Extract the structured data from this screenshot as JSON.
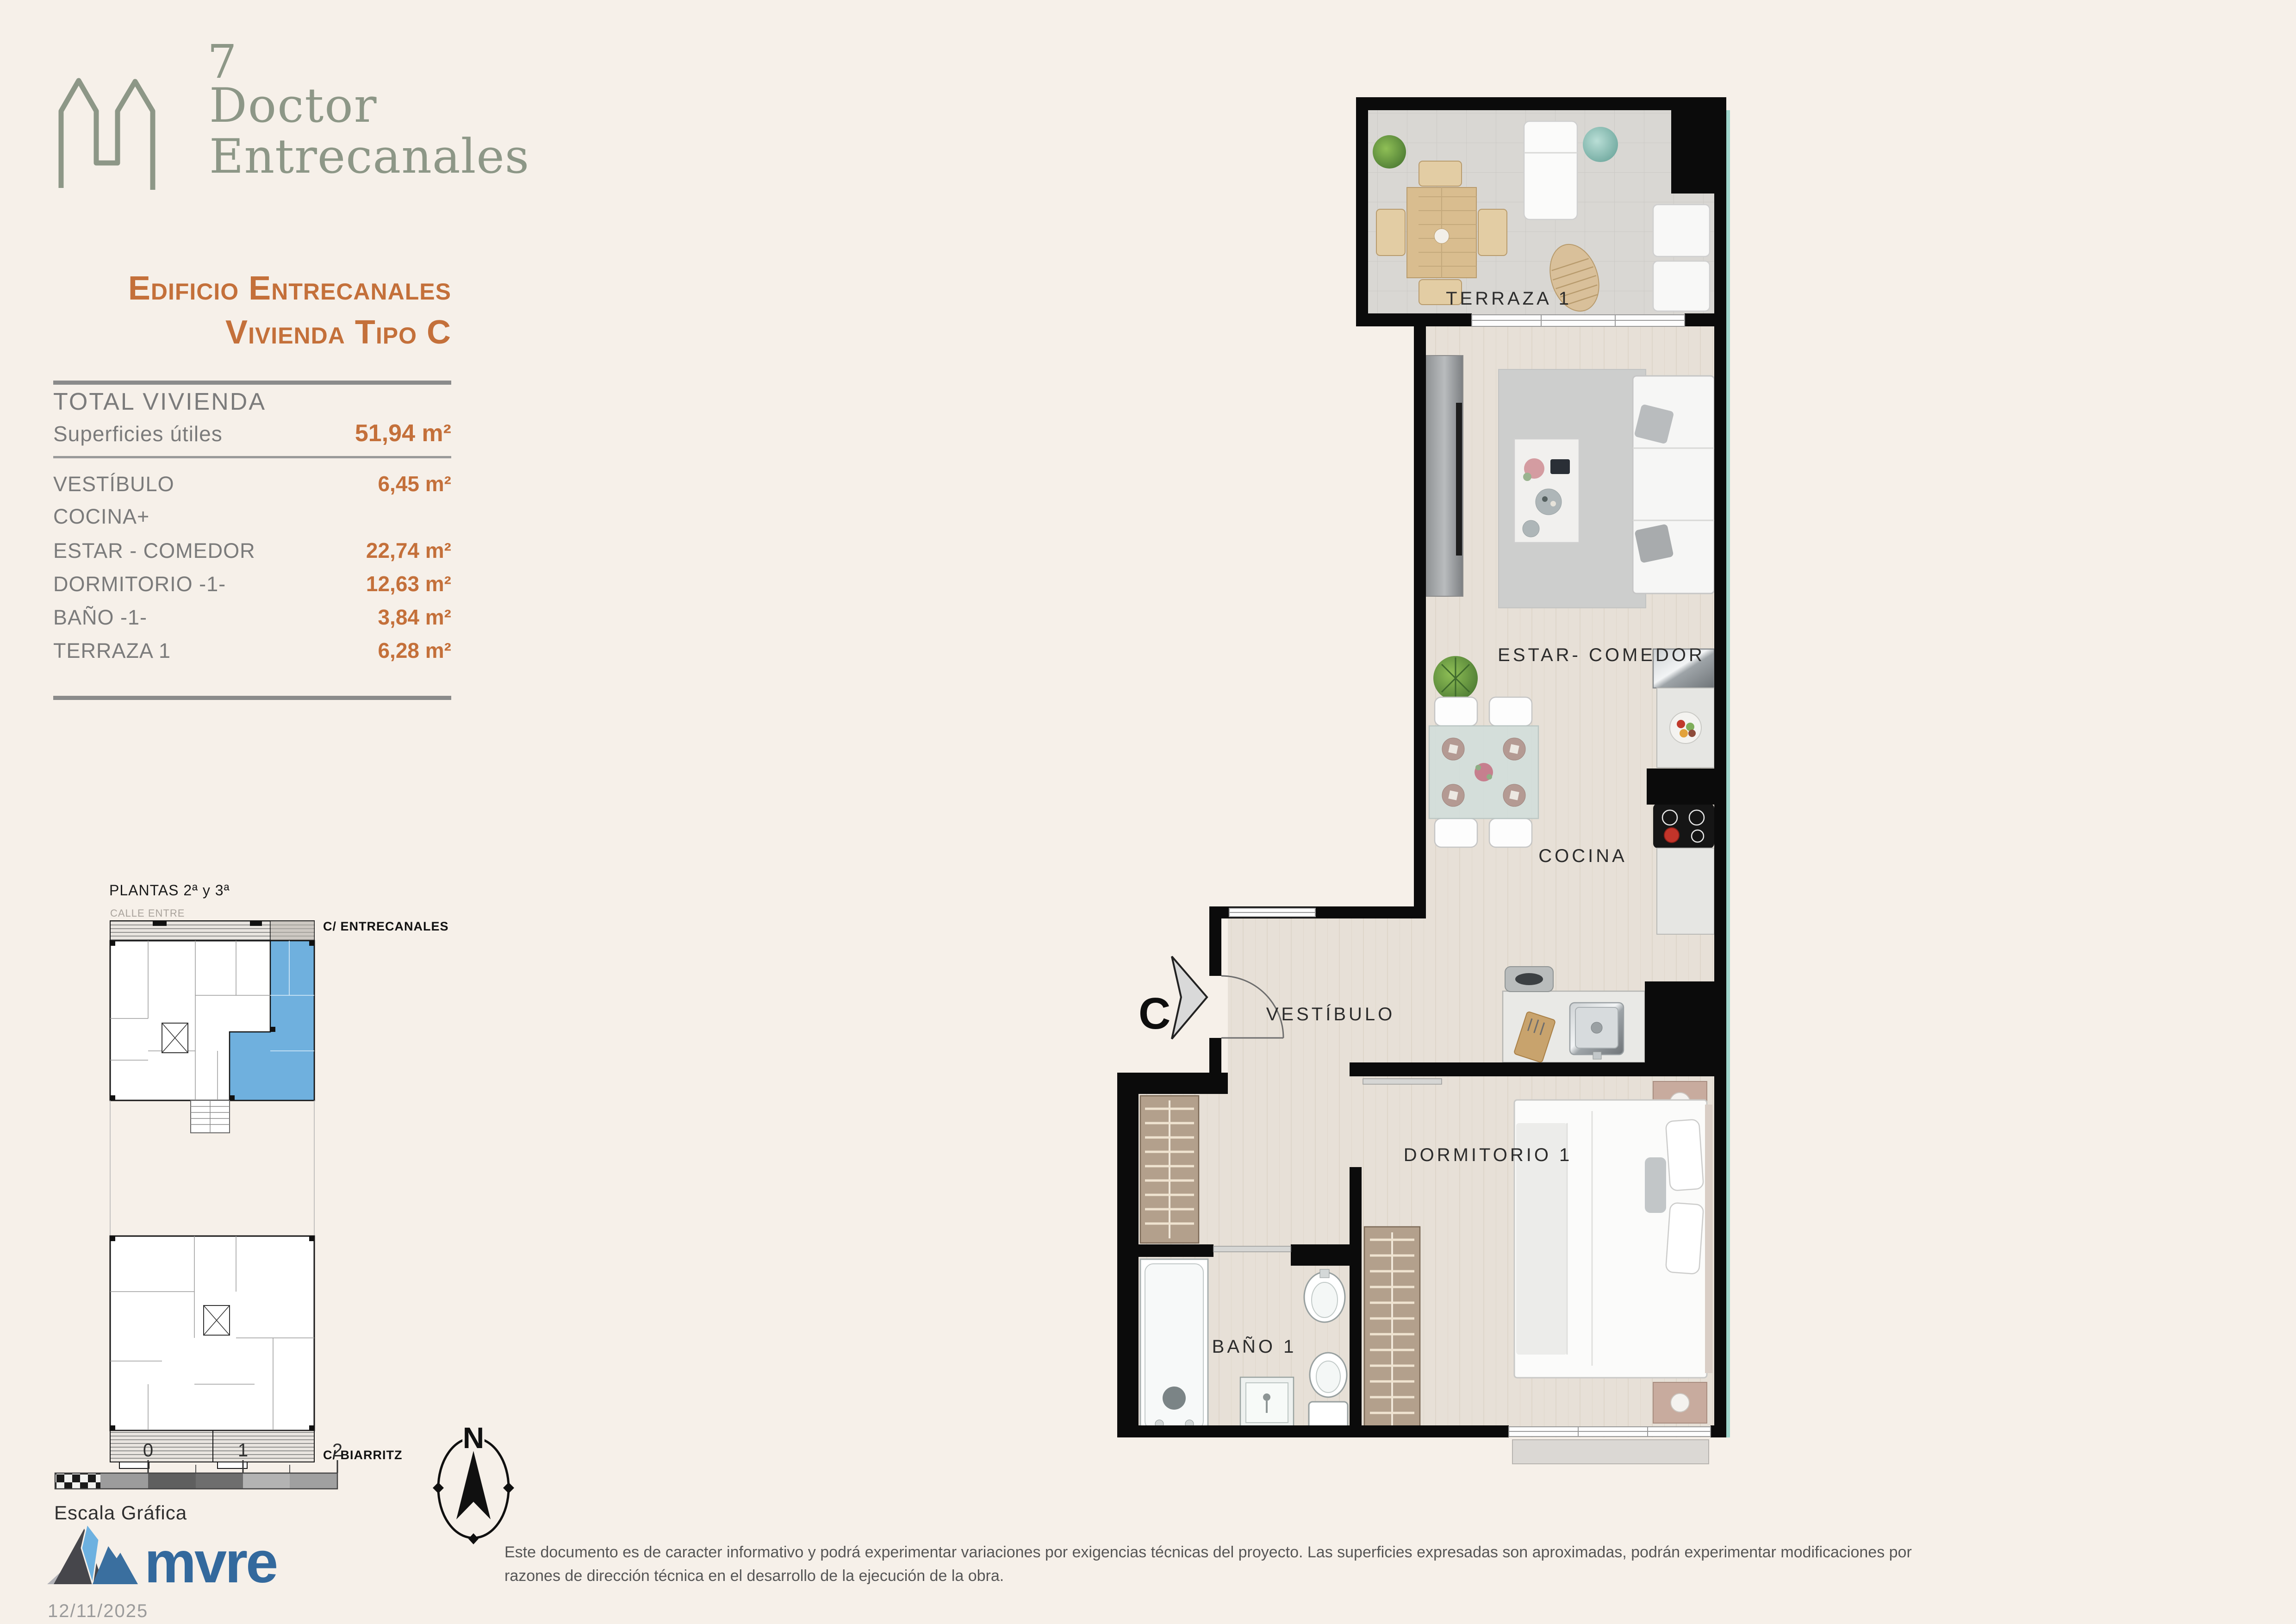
{
  "brand": {
    "number": "7",
    "line1": "Doctor",
    "line2": "Entrecanales",
    "color": "#8d9787"
  },
  "title": {
    "line1": "Edificio Entrecanales",
    "line2": "Vivienda Tipo C",
    "accent_color": "#c4703a"
  },
  "summary": {
    "heading": "TOTAL VIVIENDA",
    "label": "Superficies útiles",
    "value": "51,94 m²"
  },
  "rooms": [
    {
      "label": "VESTÍBULO",
      "value": "6,45 m²"
    },
    {
      "label": "COCINA+",
      "value": ""
    },
    {
      "label": "ESTAR - COMEDOR",
      "value": "22,74 m²"
    },
    {
      "label": "DORMITORIO -1-",
      "value": "12,63 m²"
    },
    {
      "label": "BAÑO -1-",
      "value": "3,84 m²"
    },
    {
      "label": "TERRAZA 1",
      "value": "6,28 m²"
    }
  ],
  "keyplan": {
    "title": "PLANTAS 2ª y 3ª",
    "street_top": "CALLE ENTRE",
    "street_right": "C/ ENTRECANALES",
    "street_bottom": "C/ BIARRITZ",
    "highlight_color": "#6fb0de"
  },
  "plan": {
    "entrance_letter": "C",
    "labels": {
      "terraza": "TERRAZA 1",
      "estar": "ESTAR- COMEDOR",
      "cocina": "COCINA",
      "vestibulo": "VESTÍBULO",
      "dormitorio": "DORMITORIO 1",
      "bano": "BAÑO 1"
    }
  },
  "scalebar": {
    "ticks": [
      "0",
      "1",
      "2"
    ],
    "caption": "Escala Gráfica"
  },
  "compass": {
    "north": "N"
  },
  "footer": {
    "logo": "mvre",
    "date": "12/11/2025",
    "disclaimer_line1": "Este documento es de caracter informativo y podrá experimentar variaciones por exigencias técnicas del proyecto. Las superficies expresadas son aproximadas, podrán experimentar modificaciones por",
    "disclaimer_line2": "razones de dirección técnica en el desarrollo de la ejecución de la obra."
  }
}
